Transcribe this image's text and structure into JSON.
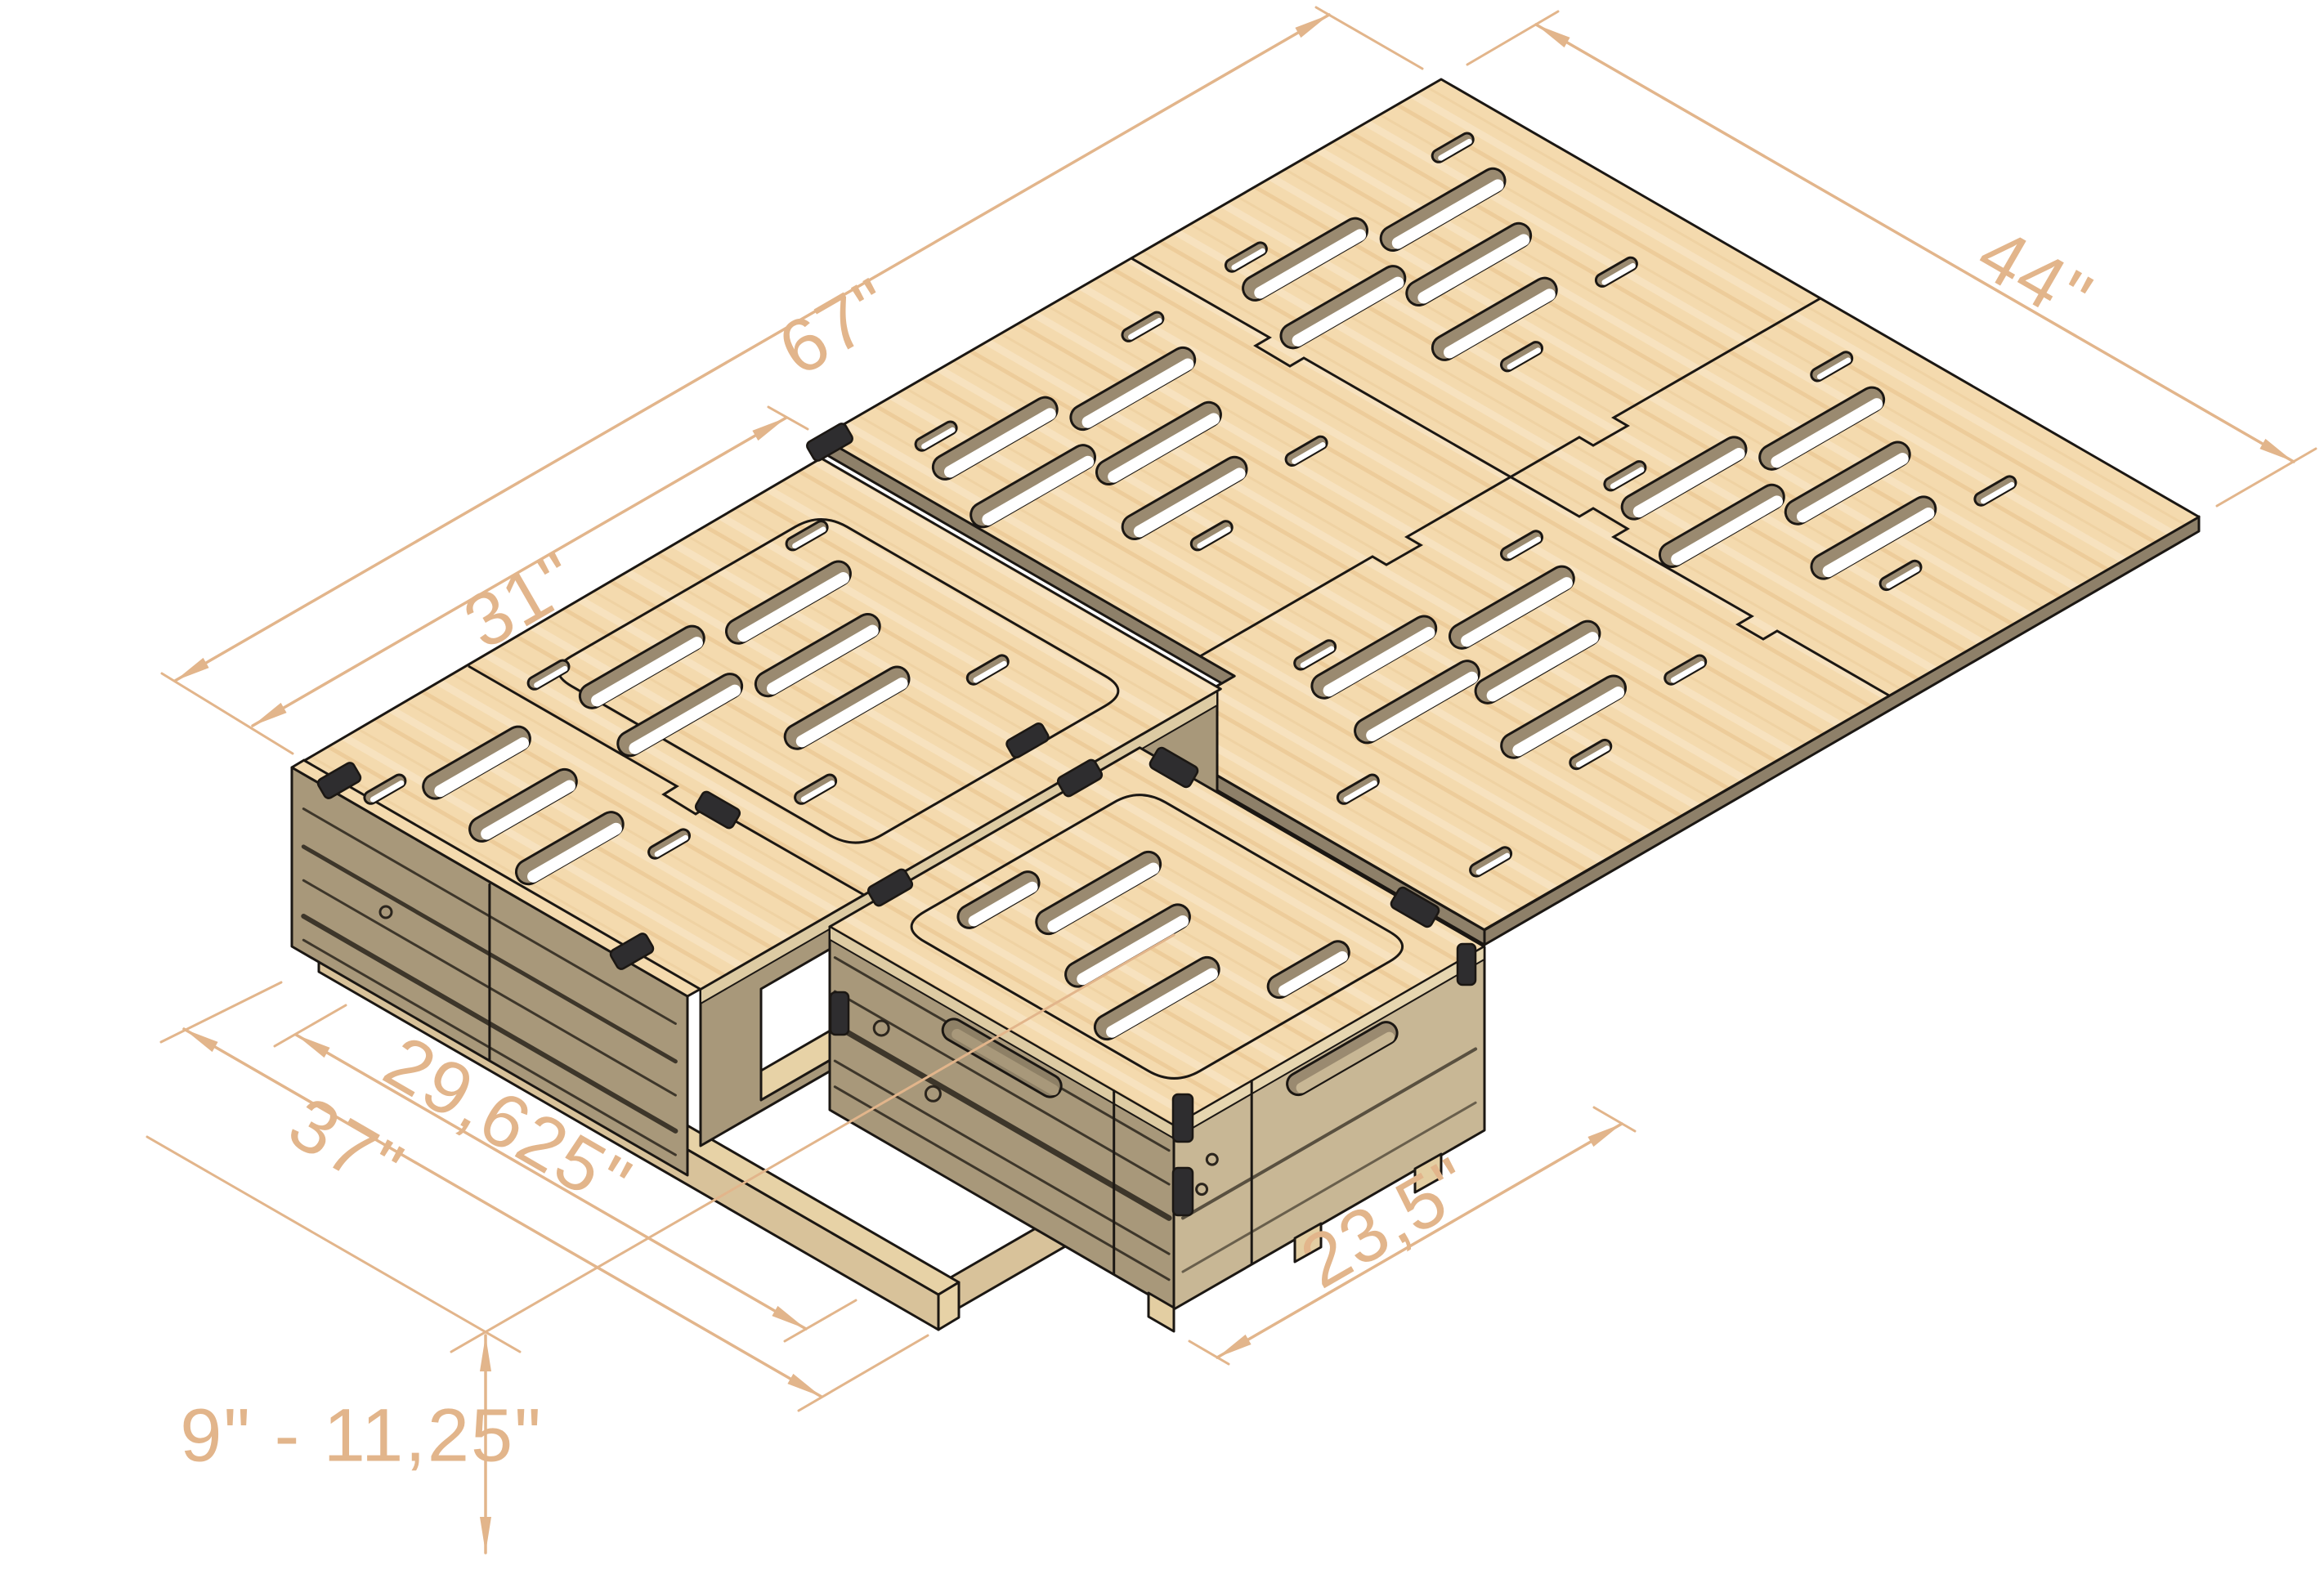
{
  "scene": {
    "type": "isometric-cad-render",
    "subject": "folding-van-bed-platform-with-seat-box",
    "background": "#ffffff"
  },
  "dimensions": {
    "length_total": "67\"",
    "width_platform": "44\"",
    "length_bench": "31\"",
    "depth_total": "37\"",
    "depth_inner": "29,625\"",
    "depth_box": "23,5\"",
    "height_range": "9\" - 11,25\""
  },
  "colors": {
    "dimension": "#E2B58B",
    "line": "#1B1713",
    "wood_top": "#F4DAAE",
    "wood_grain": "#ECCA96",
    "edge": "#8E8069",
    "slot_wall": "#9A8A70",
    "side_shadow": "#A8987A",
    "side_lit": "#C8B795",
    "inner_dark": "#8F8168",
    "rail": "#E7D2A6",
    "rail_side": "#D8C29A",
    "edge_band": "#DDCBA3",
    "latch": "#2E2D2F",
    "streak": "#2B251D"
  }
}
